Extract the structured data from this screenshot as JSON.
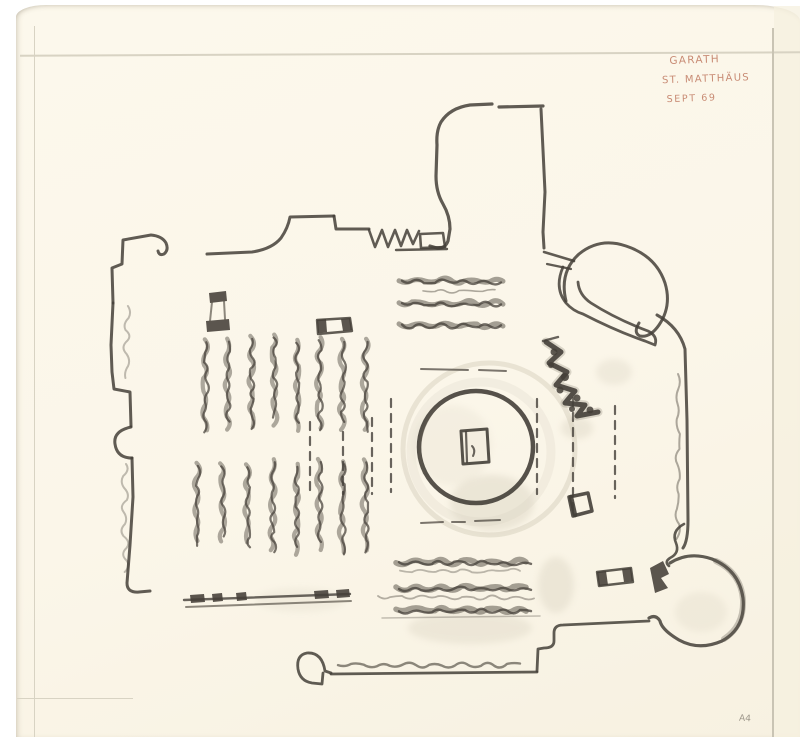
{
  "document": {
    "kind": "hand-drawn architectural floor plan sketch (charcoal on cream paper)",
    "annotations": {
      "line1": "GARATH",
      "line2": "ST. MATTHÄUS",
      "line3": "SEPT 69",
      "sheet_mark": "A4"
    },
    "colors": {
      "background": "#ffffff",
      "paper": "#fbf6e9",
      "ruled_line": "#d8d3c3",
      "ink_annotation": "#c4826a",
      "sheet_mark_color": "#8f897d",
      "charcoal_dark": "#443f38",
      "charcoal_mid": "#5d574d",
      "charcoal_light": "#8d877b",
      "smudge": "#cfc8b5"
    }
  }
}
